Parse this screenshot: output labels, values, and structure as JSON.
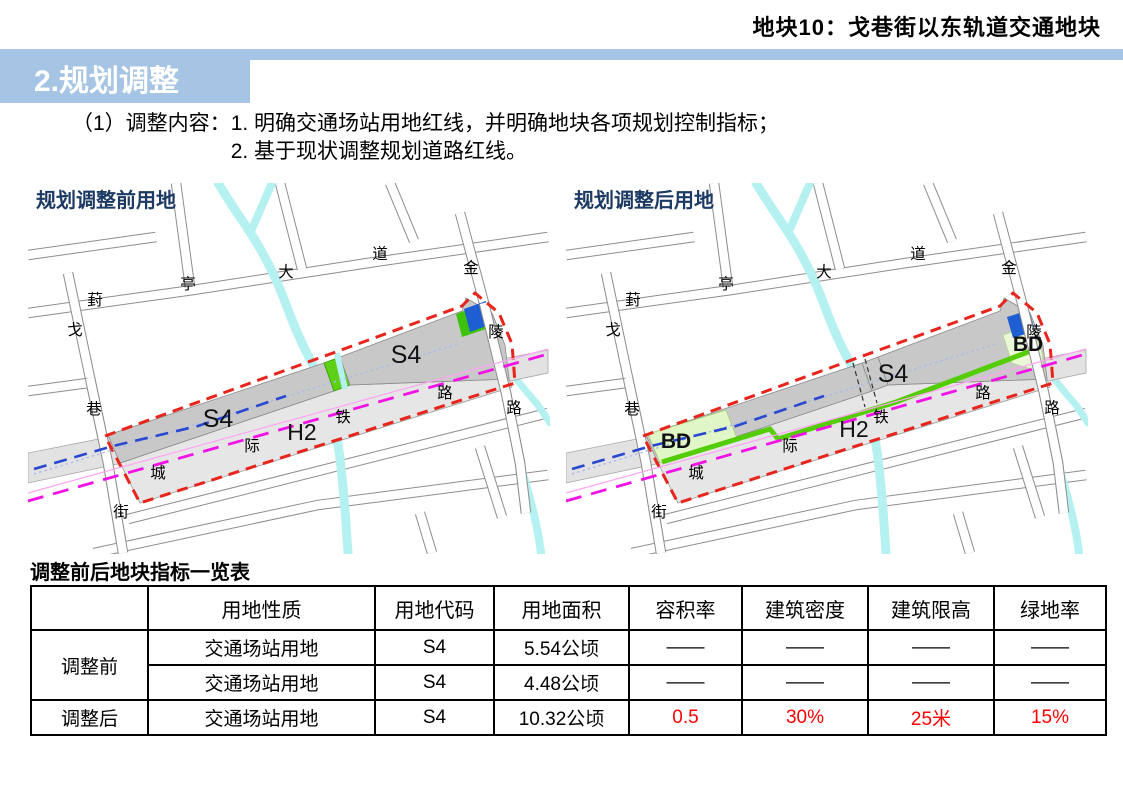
{
  "header": {
    "note": "地块10：戈巷街以东轨道交通地块",
    "section_title": "2.规划调整"
  },
  "content": {
    "label": "（1）调整内容：",
    "items": [
      "1. 明确交通场站用地红线，并明确地块各项规划控制指标；",
      "2. 基于现状调整规划道路红线。"
    ]
  },
  "maps": {
    "before": {
      "title": "规划调整前用地",
      "parcel_labels": [
        "S4",
        "S4",
        "H2"
      ]
    },
    "after": {
      "title": "规划调整后用地",
      "parcel_labels": [
        "S4",
        "H2",
        "BD",
        "BD"
      ]
    },
    "road_names": [
      "葑亭大道",
      "金陵路",
      "戈巷街",
      "城际铁路"
    ]
  },
  "colors": {
    "accent_blue": "#a6c4e4",
    "map_title_blue": "#1c3a63",
    "red_boundary": "#e8251c",
    "rail_magenta": "#f113e6",
    "rail_magenta_thin": "#ffa4f3",
    "metro_blue": "#2a47cf",
    "metro_dotted": "#a9b9e9",
    "water_cyan": "#b5f1f0",
    "road_gray": "#8d8d8d",
    "parcel_s4_gray": "#c8c8c8",
    "parcel_h2_gray": "#e6e6e6",
    "corridor_gray": "#e2e2e2",
    "green_strip": "#54cd05",
    "wedge_green": "#5ed117",
    "bd_pale_green": "#e0f6c6",
    "bd_pale_green_east": "#eaf8d8",
    "square_blue": "#1d5fd2",
    "square_green_border": "#3ec20c",
    "table_red": "#fe0000"
  },
  "table": {
    "title": "调整前后地块指标一览表",
    "headers": [
      "",
      "用地性质",
      "用地代码",
      "用地面积",
      "容积率",
      "建筑密度",
      "建筑限高",
      "绿地率"
    ],
    "row_groups": [
      {
        "label": "调整前",
        "rows": [
          {
            "cells": [
              "交通场站用地",
              "S4",
              "5.54公顷",
              "——",
              "——",
              "——",
              "——"
            ],
            "red_from": null
          },
          {
            "cells": [
              "交通场站用地",
              "S4",
              "4.48公顷",
              "——",
              "——",
              "——",
              "——"
            ],
            "red_from": null
          }
        ]
      },
      {
        "label": "调整后",
        "rows": [
          {
            "cells": [
              "交通场站用地",
              "S4",
              "10.32公顷",
              "0.5",
              "30%",
              "25米",
              "15%"
            ],
            "red_from": 3
          }
        ]
      }
    ]
  }
}
